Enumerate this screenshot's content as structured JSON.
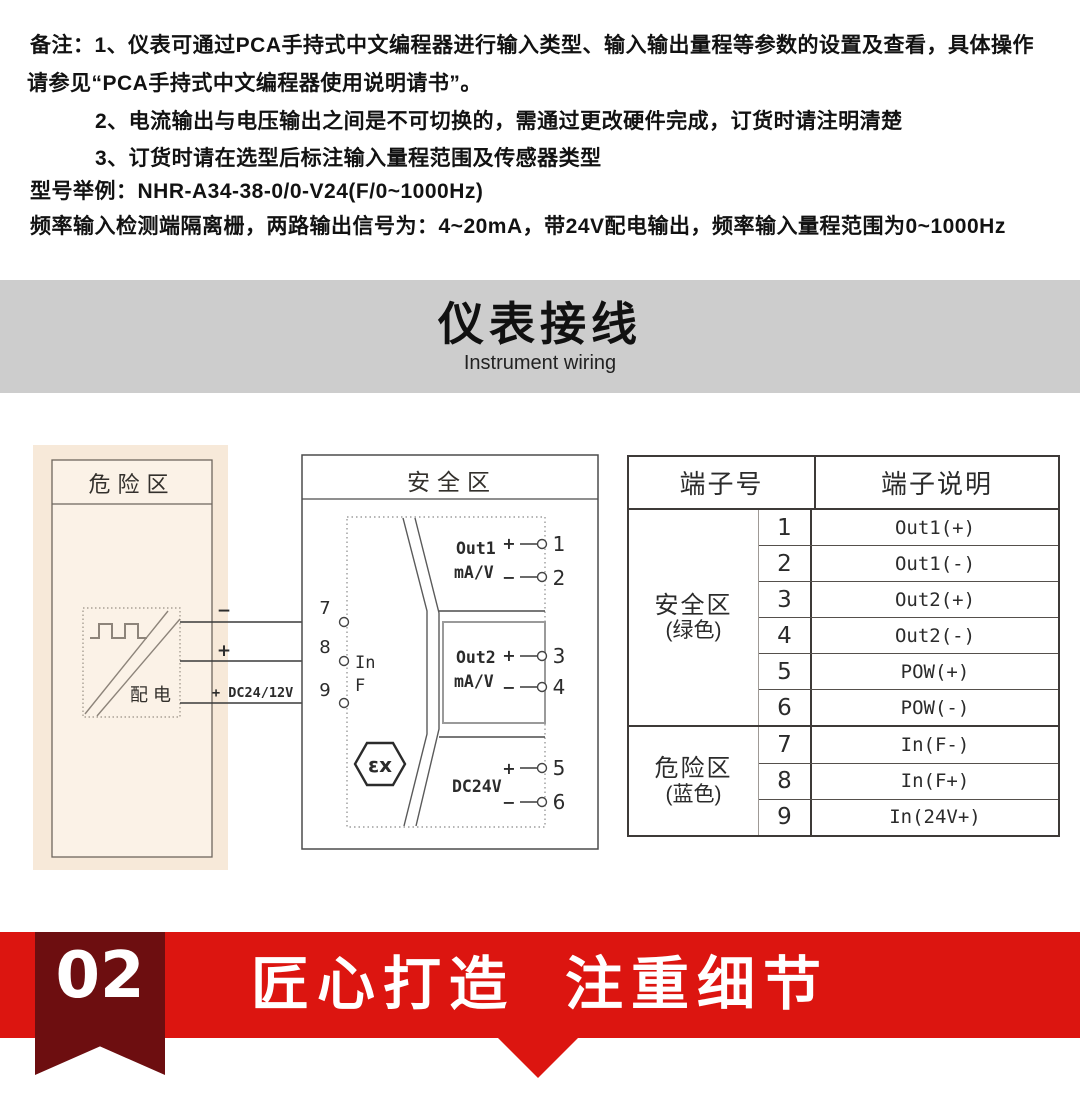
{
  "notes": {
    "line1": "备注：1、仪表可通过PCA手持式中文编程器进行输入类型、输入输出量程等参数的设置及查看，具体操作",
    "line2": "请参见“PCA手持式中文编程器使用说明请书”。",
    "line3": "2、电流输出与电压输出之间是不可切换的，需通过更改硬件完成，订货时请注明清楚",
    "line4": "3、订货时请在选型后标注输入量程范围及传感器类型",
    "line5": "型号举例：NHR-A34-38-0/0-V24(F/0~1000Hz)",
    "line6": "频率输入检测端隔离栅，两路输出信号为：4~20mA，带24V配电输出，频率输入量程范围为0~1000Hz"
  },
  "banner": {
    "title": "仪表接线",
    "subtitle": "Instrument wiring",
    "bg_color": "#cdcdcd"
  },
  "diagram": {
    "danger": {
      "title": "危险区",
      "device_label": "配电",
      "wire1_label": "−",
      "wire2_label": "+",
      "wire3_label": "+ DC24/12V",
      "bg_color": "#f7e9d9"
    },
    "safe": {
      "title": "安全区",
      "terminal7": "7",
      "terminal8": "8",
      "terminal9": "9",
      "input_label1": "In",
      "input_label2": "F",
      "out1": {
        "name": "Out1",
        "unit": "mA/V",
        "plus": "+",
        "minus": "−",
        "plus_num": "1",
        "minus_num": "2"
      },
      "out2": {
        "name": "Out2",
        "unit": "mA/V",
        "plus": "+",
        "minus": "−",
        "plus_num": "3",
        "minus_num": "4"
      },
      "power": {
        "name": "DC24V",
        "plus": "+",
        "minus": "−",
        "plus_num": "5",
        "minus_num": "6"
      },
      "ex_mark": "εx"
    }
  },
  "table": {
    "header_no": "端子号",
    "header_desc": "端子说明",
    "groups": [
      {
        "zone": "安全区",
        "note": "(绿色)",
        "rows": [
          [
            "1",
            "Out1(+)"
          ],
          [
            "2",
            "Out1(-)"
          ],
          [
            "3",
            "Out2(+)"
          ],
          [
            "4",
            "Out2(-)"
          ],
          [
            "5",
            "POW(+)"
          ],
          [
            "6",
            "POW(-)"
          ]
        ]
      },
      {
        "zone": "危险区",
        "note": "(蓝色)",
        "rows": [
          [
            "7",
            "In(F-)"
          ],
          [
            "8",
            "In(F+)"
          ],
          [
            "9",
            "In(24V+)"
          ]
        ]
      }
    ]
  },
  "footer": {
    "number": "02",
    "title": "匠心打造 注重细节",
    "band_color": "#dc1510",
    "ribbon_color": "#6d0e10"
  }
}
